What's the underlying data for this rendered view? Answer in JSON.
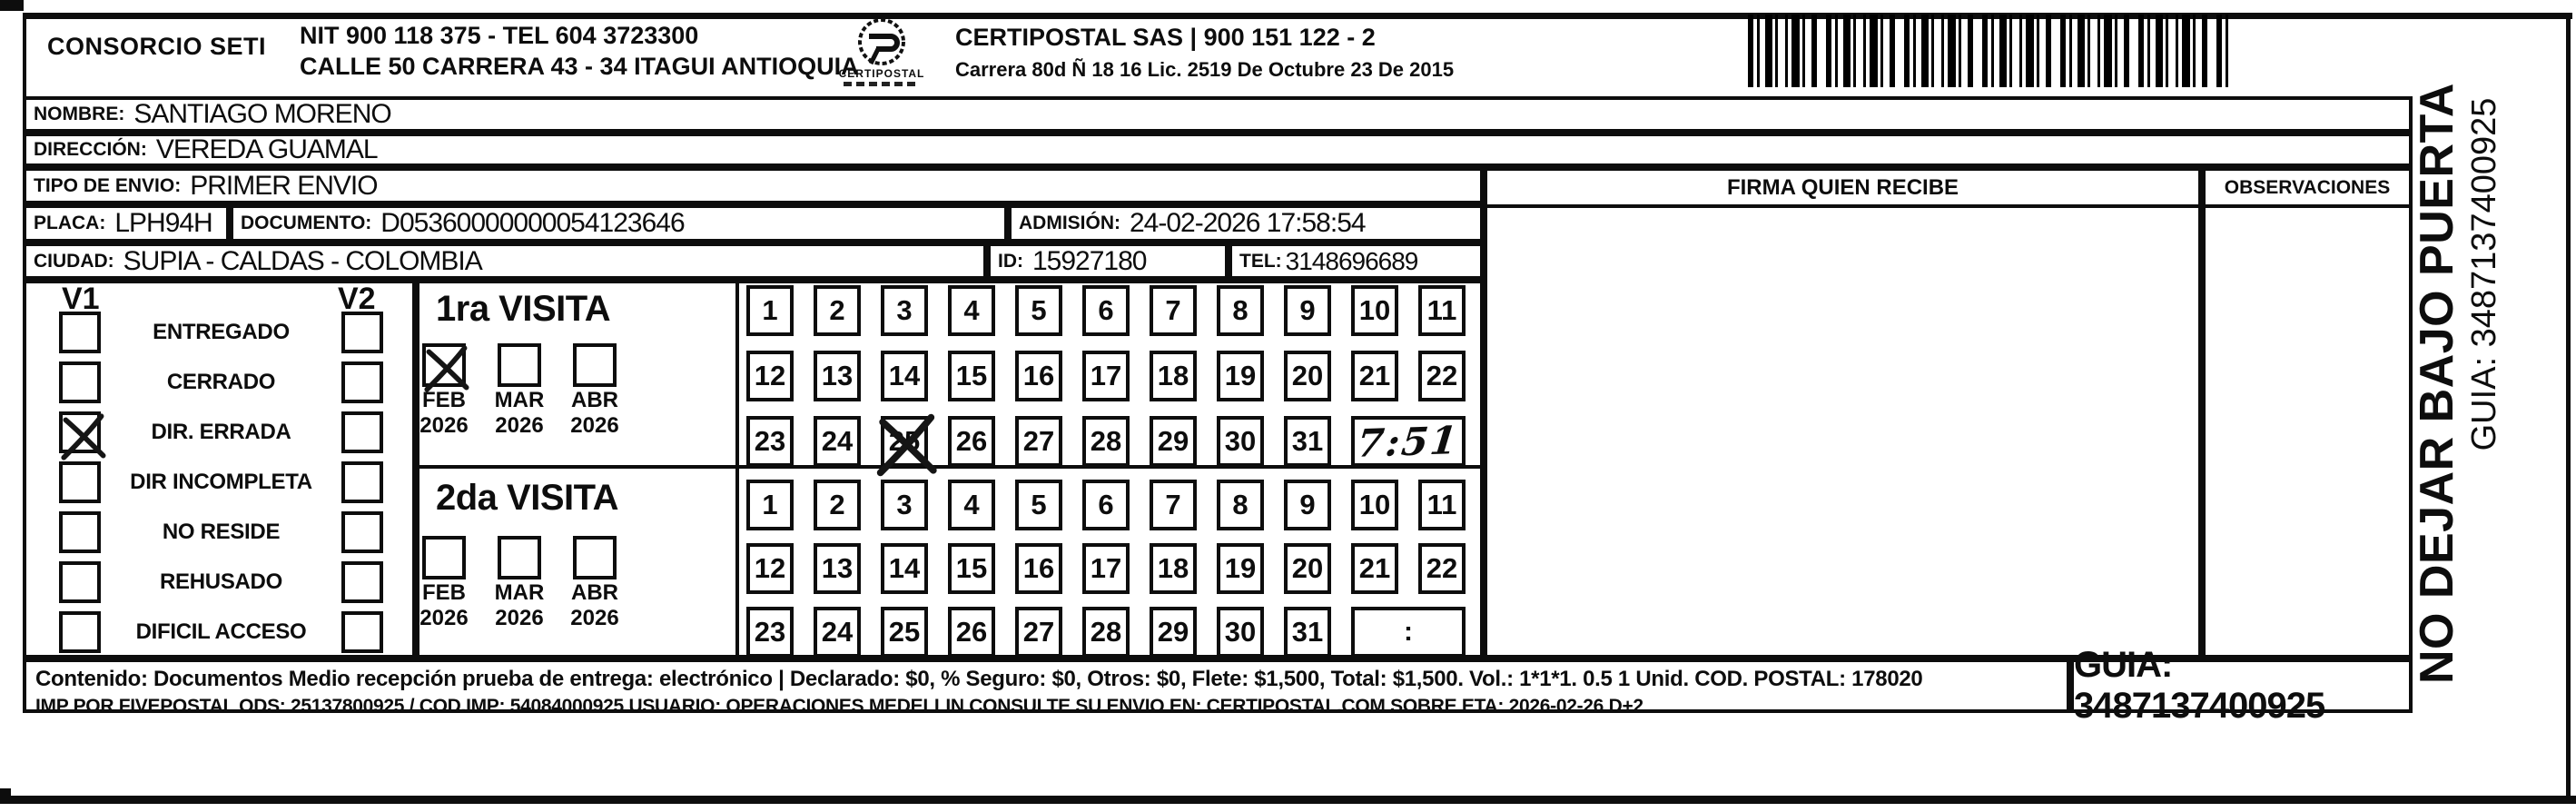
{
  "header": {
    "company": "CONSORCIO SETI",
    "nit_tel": "NIT 900 118 375 - TEL 604 3723300",
    "address": "CALLE 50 CARRERA 43 - 34 ITAGUI ANTIOQUIA",
    "logo_caption": "CERTIPOSTAL",
    "partner": "CERTIPOSTAL SAS | 900 151 122 - 2",
    "partner_address": "Carrera 80d Ñ 18 16  Lic. 2519 De Octubre 23 De 2015"
  },
  "shipment": {
    "nombre_label": "NOMBRE:",
    "nombre": "SANTIAGO MORENO",
    "direccion_label": "DIRECCIÓN:",
    "direccion": "VEREDA GUAMAL",
    "tipo_envio_label": "TIPO DE ENVIO:",
    "tipo_envio": "PRIMER ENVIO",
    "placa_label": "PLACA:",
    "placa": "LPH94H",
    "documento_label": "DOCUMENTO:",
    "documento": "D05360000000054123646",
    "admision_label": "ADMISIÓN:",
    "admision": "24-02-2026 17:58:54",
    "ciudad_label": "CIUDAD:",
    "ciudad": "SUPIA - CALDAS - COLOMBIA",
    "id_label": "ID:",
    "id_value": "15927180",
    "tel_label": "TEL:",
    "tel": "3148696689"
  },
  "columns": {
    "firma": "FIRMA QUIEN RECIBE",
    "observaciones": "OBSERVACIONES"
  },
  "status_panel": {
    "v1_header": "V1",
    "v2_header": "V2",
    "items": [
      {
        "label": "ENTREGADO",
        "v1": false,
        "v2": false
      },
      {
        "label": "CERRADO",
        "v1": false,
        "v2": false
      },
      {
        "label": "DIR. ERRADA",
        "v1": true,
        "v2": false
      },
      {
        "label": "DIR INCOMPLETA",
        "v1": false,
        "v2": false
      },
      {
        "label": "NO RESIDE",
        "v1": false,
        "v2": false
      },
      {
        "label": "REHUSADO",
        "v1": false,
        "v2": false
      },
      {
        "label": "DIFICIL ACCESO",
        "v1": false,
        "v2": false
      }
    ]
  },
  "day_rows": [
    [
      1,
      2,
      3,
      4,
      5,
      6,
      7,
      8,
      9,
      10,
      11
    ],
    [
      12,
      13,
      14,
      15,
      16,
      17,
      18,
      19,
      20,
      21,
      22
    ],
    [
      23,
      24,
      25,
      26,
      27,
      28,
      29,
      30,
      31
    ]
  ],
  "visits": [
    {
      "title": "1ra VISITA",
      "months": [
        {
          "month": "FEB",
          "year": "2026",
          "checked": true
        },
        {
          "month": "MAR",
          "year": "2026",
          "checked": false
        },
        {
          "month": "ABR",
          "year": "2026",
          "checked": false
        }
      ],
      "crossed_days": [
        25
      ],
      "time": "7:51",
      "time_handwritten": true
    },
    {
      "title": "2da VISITA",
      "months": [
        {
          "month": "FEB",
          "year": "2026",
          "checked": false
        },
        {
          "month": "MAR",
          "year": "2026",
          "checked": false
        },
        {
          "month": "ABR",
          "year": "2026",
          "checked": false
        }
      ],
      "crossed_days": [],
      "time": ":",
      "time_handwritten": false
    }
  ],
  "footer": {
    "line1": "Contenido: Documentos Medio recepción prueba de entrega: electrónico | Declarado: $0, % Seguro: $0, Otros: $0, Flete: $1,500, Total: $1,500. Vol.: 1*1*1. 0.5  1 Unid. COD. POSTAL: 178020",
    "line2": "IMP POR FIVEPOSTAL ODS: 25137800925 / COD.IMP: 54084000925 USUARIO: OPERACIONES MEDELLIN CONSULTE SU ENVIO EN: CERTIPOSTAL.COM SOBRE ETA: 2026-02-26 D+2",
    "guia_box": "GUIA: 3487137400925"
  },
  "side_label": {
    "warning": "NO DEJAR BAJO PUERTA",
    "guia": "GUIA: 3487137400925"
  },
  "colors": {
    "ink": "#0d0d0d",
    "paper": "#ffffff"
  }
}
